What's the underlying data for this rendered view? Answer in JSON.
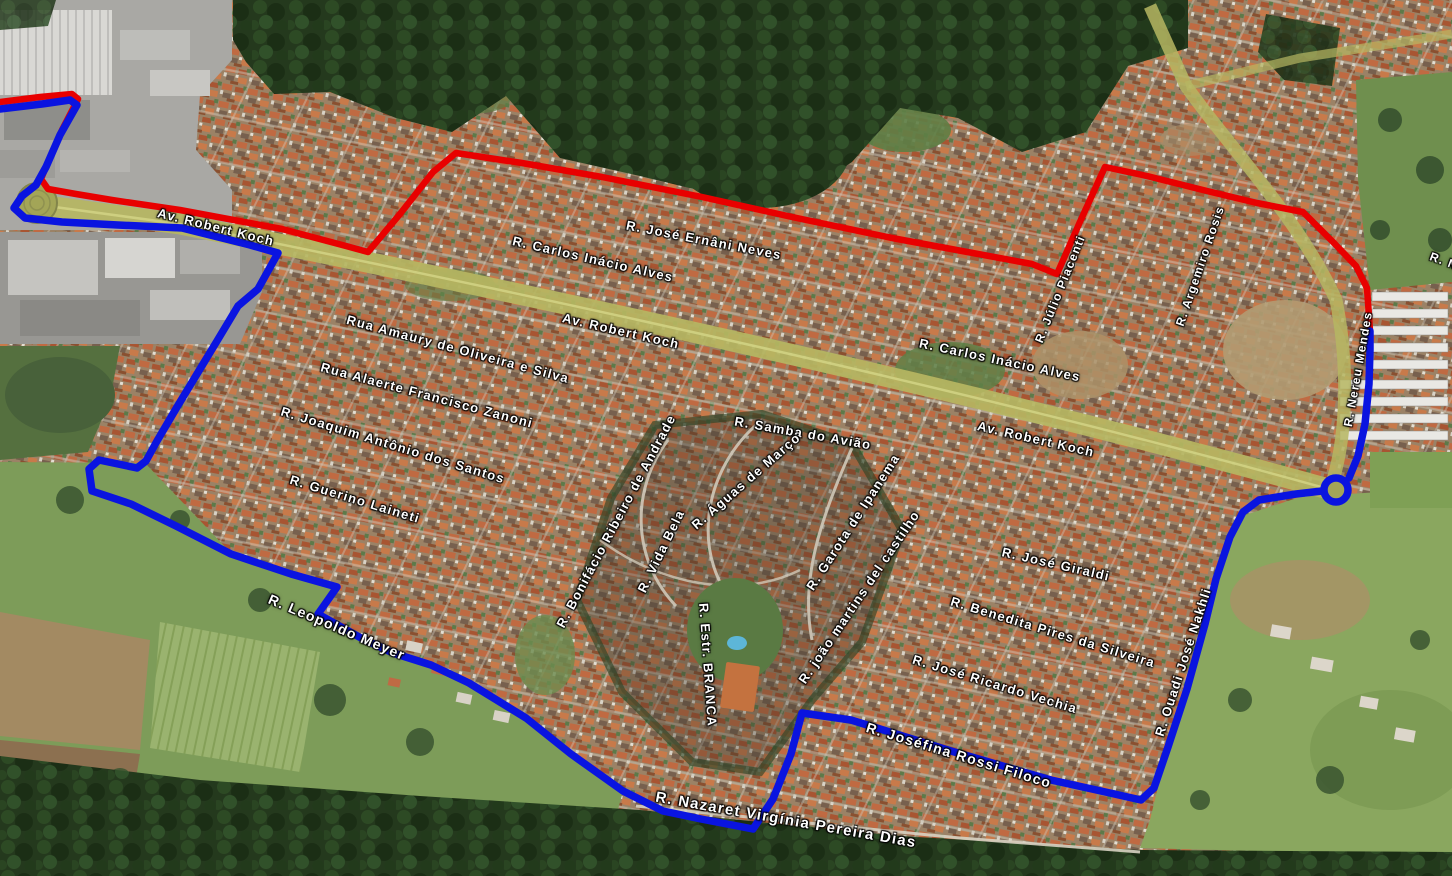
{
  "map": {
    "description": "Oblique aerial satellite view of residential neighborhoods (orange-roof blocks, central gated condominium, farmland lower-left, forest band top and bottom) with a red route and a blue route drawn over the streets, street-name labels in white, and Av. Robert Koch running diagonally with roundabouts at both ends",
    "colors": {
      "red_route": "#e80000",
      "blue_route": "#0a14e0",
      "avenue_road": "#b6b662",
      "label_text": "#ffffff",
      "label_halo": "#000000"
    },
    "street_labels": [
      {
        "text": "Av. Robert Koch",
        "x": 216,
        "y": 227,
        "rot": 14,
        "size": 13
      },
      {
        "text": "R. Carlos Inácio Alves",
        "x": 593,
        "y": 259,
        "rot": 13,
        "size": 13
      },
      {
        "text": "R. José Ernâni Neves",
        "x": 704,
        "y": 240,
        "rot": 11,
        "size": 13
      },
      {
        "text": "Rua Amaury de Oliveira e Silva",
        "x": 458,
        "y": 349,
        "rot": 15,
        "size": 13
      },
      {
        "text": "Av. Robert Koch",
        "x": 621,
        "y": 331,
        "rot": 13,
        "size": 13
      },
      {
        "text": "Rua Alaerte Francisco Zanoni",
        "x": 427,
        "y": 395,
        "rot": 15,
        "size": 13
      },
      {
        "text": "R. Joaquim Antônio dos Santos",
        "x": 393,
        "y": 445,
        "rot": 17,
        "size": 13
      },
      {
        "text": "R. Guerino Laineti",
        "x": 355,
        "y": 499,
        "rot": 17,
        "size": 13
      },
      {
        "text": "R. Carlos Inácio Alves",
        "x": 1000,
        "y": 360,
        "rot": 12,
        "size": 13
      },
      {
        "text": "Av. Robert Koch",
        "x": 1036,
        "y": 439,
        "rot": 13,
        "size": 13
      },
      {
        "text": "R. Samba do Avião",
        "x": 803,
        "y": 433,
        "rot": 10,
        "size": 13
      },
      {
        "text": "R. Águas de Março",
        "x": 746,
        "y": 481,
        "rot": -41,
        "size": 13
      },
      {
        "text": "R. Garota de Ipanema",
        "x": 853,
        "y": 522,
        "rot": -57,
        "size": 13
      },
      {
        "text": "R. Bonifácio Ribeiro de Andrade",
        "x": 616,
        "y": 521,
        "rot": -62,
        "size": 13
      },
      {
        "text": "R. Vida Bela",
        "x": 661,
        "y": 551,
        "rot": -64,
        "size": 13
      },
      {
        "text": "R. Estr. BRANCA",
        "x": 708,
        "y": 665,
        "rot": 86,
        "size": 13
      },
      {
        "text": "R. joão martins del castilho",
        "x": 859,
        "y": 597,
        "rot": -56,
        "size": 13
      },
      {
        "text": "R. José Giraldi",
        "x": 1056,
        "y": 564,
        "rot": 13,
        "size": 13
      },
      {
        "text": "R. Benedita Pires da Silveira",
        "x": 1053,
        "y": 632,
        "rot": 17,
        "size": 13
      },
      {
        "text": "R. José Ricardo Vechia",
        "x": 995,
        "y": 684,
        "rot": 17,
        "size": 13
      },
      {
        "text": "R. Joséfina Rossi Filoco",
        "x": 959,
        "y": 755,
        "rot": 17,
        "size": 14
      },
      {
        "text": "R. Nazaret Virgínia Pereira Dias",
        "x": 786,
        "y": 820,
        "rot": 10,
        "size": 15
      },
      {
        "text": "R. Ouadi José Nakhli",
        "x": 1183,
        "y": 662,
        "rot": -72,
        "size": 13
      },
      {
        "text": "R. Leopoldo Meyer",
        "x": 337,
        "y": 627,
        "rot": 23,
        "size": 14
      },
      {
        "text": "R. Nereu Mendes",
        "x": 1358,
        "y": 369,
        "rot": -80,
        "size": 12
      },
      {
        "text": "R. Júlio Piacenti",
        "x": 1060,
        "y": 289,
        "rot": -68,
        "size": 12
      },
      {
        "text": "R. Argemiro Rosis",
        "x": 1200,
        "y": 266,
        "rot": -71,
        "size": 12
      },
      {
        "text": "R. N",
        "x": 1444,
        "y": 261,
        "rot": 20,
        "size": 12
      }
    ],
    "routes": [
      {
        "name": "red-route",
        "color": "#e80000",
        "width": 6.5,
        "segments": [
          [
            [
              0,
              102
            ],
            [
              40,
              97
            ],
            [
              72,
              94
            ],
            [
              78,
              99
            ],
            [
              62,
              130
            ],
            [
              48,
              162
            ],
            [
              41,
              179
            ],
            [
              48,
              189
            ],
            [
              76,
              194
            ],
            [
              112,
              200
            ],
            [
              180,
              210
            ],
            [
              282,
              229
            ],
            [
              346,
              246
            ],
            [
              368,
              252
            ],
            [
              400,
              214
            ],
            [
              433,
              172
            ],
            [
              456,
              153
            ],
            [
              522,
              163
            ],
            [
              602,
              177
            ],
            [
              702,
              197
            ],
            [
              792,
              217
            ],
            [
              892,
              238
            ],
            [
              962,
              251
            ],
            [
              1032,
              264
            ],
            [
              1057,
              274
            ],
            [
              1079,
              224
            ],
            [
              1099,
              180
            ],
            [
              1105,
              167
            ],
            [
              1147,
              176
            ],
            [
              1207,
              191
            ],
            [
              1257,
              203
            ],
            [
              1303,
              212
            ],
            [
              1333,
              242
            ],
            [
              1356,
              266
            ],
            [
              1367,
              288
            ],
            [
              1370,
              331
            ]
          ]
        ],
        "loops": []
      },
      {
        "name": "blue-route",
        "color": "#0a14e0",
        "width": 7.5,
        "segments": [
          [
            [
              0,
              109
            ],
            [
              42,
              104
            ],
            [
              70,
              100
            ],
            [
              77,
              105
            ],
            [
              60,
              135
            ],
            [
              46,
              167
            ],
            [
              36,
              185
            ],
            [
              22,
              196
            ],
            [
              14,
              208
            ],
            [
              25,
              218
            ],
            [
              62,
              222
            ],
            [
              118,
              225
            ],
            [
              182,
              228
            ],
            [
              250,
              245
            ],
            [
              278,
              253
            ],
            [
              258,
              289
            ],
            [
              238,
              306
            ],
            [
              217,
              341
            ],
            [
              197,
              374
            ],
            [
              177,
              407
            ],
            [
              157,
              441
            ],
            [
              146,
              461
            ],
            [
              137,
              468
            ],
            [
              99,
              460
            ],
            [
              89,
              469
            ],
            [
              92,
              491
            ],
            [
              131,
              504
            ],
            [
              176,
              526
            ],
            [
              231,
              554
            ],
            [
              291,
              574
            ],
            [
              337,
              587
            ],
            [
              318,
              614
            ],
            [
              361,
              638
            ],
            [
              393,
              653
            ],
            [
              431,
              665
            ],
            [
              469,
              683
            ],
            [
              526,
              718
            ],
            [
              571,
              754
            ],
            [
              623,
              791
            ],
            [
              663,
              811
            ],
            [
              701,
              819
            ],
            [
              753,
              829
            ],
            [
              773,
              799
            ],
            [
              791,
              754
            ],
            [
              802,
              713
            ],
            [
              851,
              720
            ],
            [
              951,
              751
            ],
            [
              1051,
              780
            ],
            [
              1101,
              791
            ],
            [
              1141,
              800
            ],
            [
              1154,
              788
            ],
            [
              1168,
              747
            ],
            [
              1187,
              689
            ],
            [
              1205,
              624
            ],
            [
              1216,
              579
            ],
            [
              1230,
              537
            ],
            [
              1243,
              512
            ],
            [
              1259,
              500
            ],
            [
              1296,
              494
            ],
            [
              1322,
              491
            ]
          ],
          [
            [
              1349,
              478
            ],
            [
              1358,
              456
            ],
            [
              1365,
              424
            ],
            [
              1369,
              384
            ],
            [
              1370,
              350
            ],
            [
              1370,
              331
            ]
          ]
        ],
        "loops": [
          {
            "cx": 1336,
            "cy": 490,
            "r": 12
          }
        ]
      }
    ],
    "roundabouts": [
      {
        "cx": 37,
        "cy": 203,
        "r": 20
      },
      {
        "cx": 1337,
        "cy": 490,
        "r": 11
      }
    ]
  }
}
